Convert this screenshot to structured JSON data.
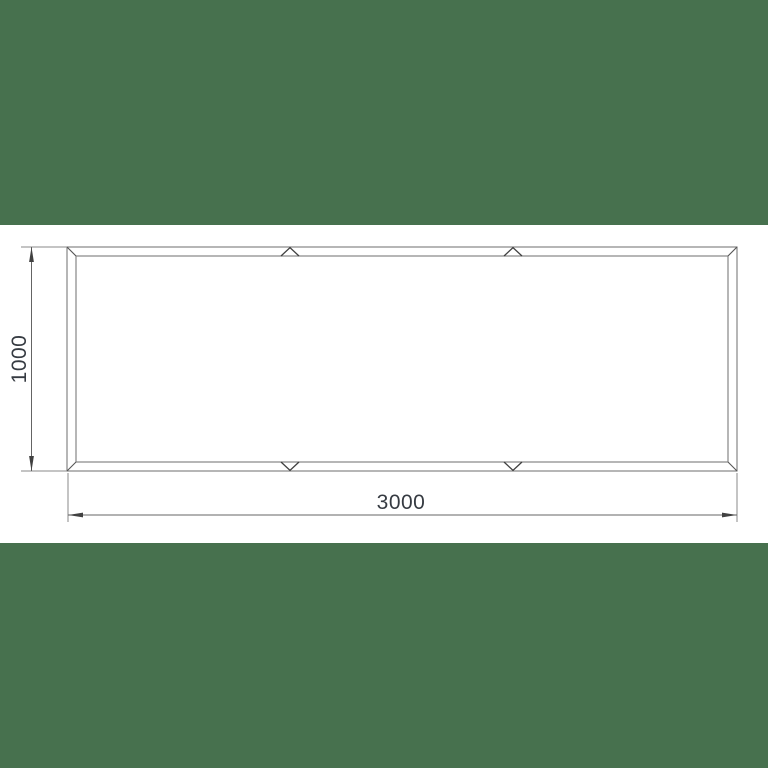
{
  "drawing": {
    "labels": {
      "width": "3000",
      "height": "1000"
    },
    "colors": {
      "band_green": "#47714e",
      "label_text": "#363b42",
      "line_gray": "#7b7b7b",
      "dim_dark": "#414141",
      "background": "#ffffff"
    }
  }
}
